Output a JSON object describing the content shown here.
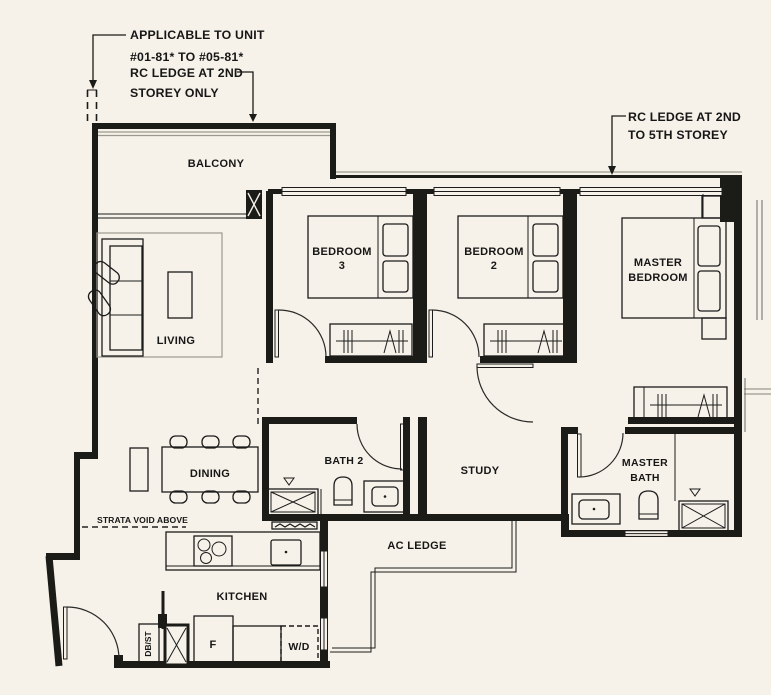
{
  "plan": {
    "annotations": {
      "applicable_unit_line1": "APPLICABLE TO UNIT",
      "applicable_unit_line2": "#01-81* TO #05-81*",
      "rc_ledge_2nd_line1": "RC LEDGE AT 2ND",
      "rc_ledge_2nd_line2": "STOREY ONLY",
      "rc_ledge_2nd_5th_line1": "RC LEDGE AT 2ND",
      "rc_ledge_2nd_5th_line2": "TO 5TH STOREY",
      "strata_void": "STRATA VOID ABOVE"
    },
    "rooms": {
      "balcony": "BALCONY",
      "living": "LIVING",
      "dining": "DINING",
      "bedroom3_line1": "BEDROOM",
      "bedroom3_line2": "3",
      "bedroom2_line1": "BEDROOM",
      "bedroom2_line2": "2",
      "master_bedroom_line1": "MASTER",
      "master_bedroom_line2": "BEDROOM",
      "bath2": "BATH 2",
      "study": "STUDY",
      "master_bath_line1": "MASTER",
      "master_bath_line2": "BATH",
      "kitchen": "KITCHEN",
      "ac_ledge": "AC LEDGE"
    },
    "fixtures": {
      "db_st": "DB/ST",
      "fridge": "F",
      "washer_dryer": "W/D"
    },
    "colors": {
      "background": "#f6f2e9",
      "wall": "#1b1b18",
      "rc_ledge_line": "#9b988f"
    }
  }
}
